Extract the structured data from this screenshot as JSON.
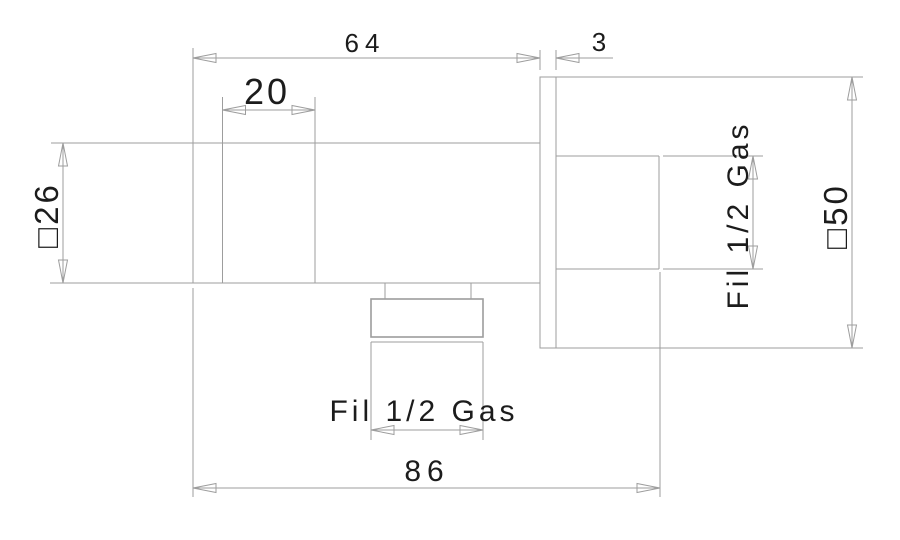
{
  "drawing": {
    "type": "technical-dimension-drawing",
    "colors": {
      "background": "#ffffff",
      "line": "#9d9d9d",
      "text": "#1c1c1c"
    },
    "dimensions": {
      "body_length": "64",
      "flange_thickness": "3",
      "collar_width": "20",
      "body_square": "□26",
      "flange_square": "□50",
      "overall_length": "86",
      "side_thread": "Fil 1/2 Gas",
      "bottom_thread": "Fil 1/2 Gas"
    }
  }
}
